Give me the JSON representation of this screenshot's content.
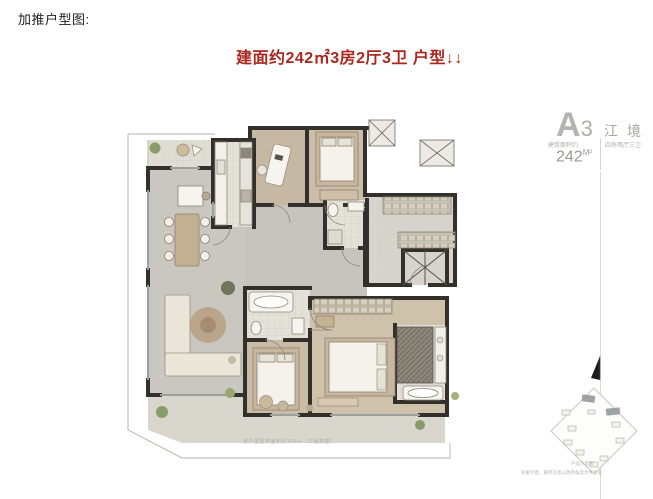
{
  "header": {
    "heading": "加推户型图:",
    "subtitle": "建面约242㎡3房2厅3卫 户型↓↓",
    "accent_red": "#ab271d"
  },
  "floorplan": {
    "caption": "该户型建筑面积约146㎡（工程数据）",
    "rooms": [
      "书房",
      "卧室",
      "卫生间",
      "玄关",
      "厨房",
      "餐厅",
      "客厅",
      "主卧",
      "主卫",
      "阳台"
    ],
    "wall_color": "#33302c",
    "wood_floor_color": "#cbbda7",
    "gray_floor_color": "#c9c7c0",
    "tile_color": "#e3e1d8"
  },
  "panel": {
    "unit_code_letter": "A",
    "unit_code_number": "3",
    "unit_name": "江境",
    "area_label": "建筑面积约",
    "rooms_label": "四房两厅三卫",
    "area_value": "242",
    "area_unit": "M²",
    "sitemap_note1": "产品示意图",
    "sitemap_note2": "效果示意，最终信息以政府备案文件为准"
  }
}
